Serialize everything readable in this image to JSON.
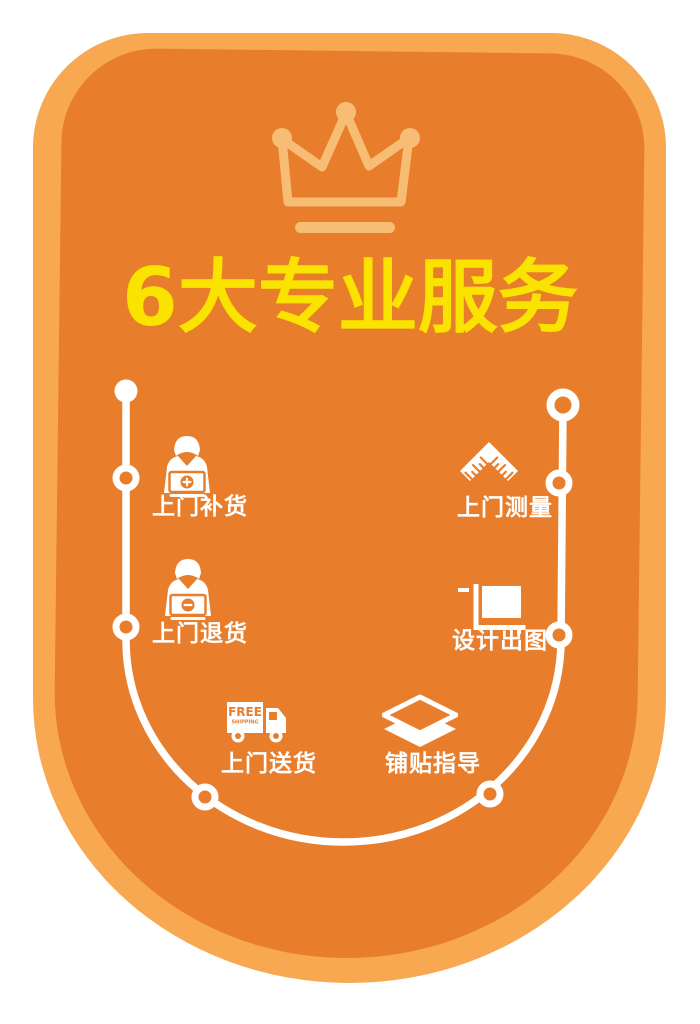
{
  "poster": {
    "title": "6大专业服务",
    "crown_icon": "crown-outline",
    "services": [
      {
        "id": "restock",
        "label": "上门补货",
        "icon": "person-box-plus"
      },
      {
        "id": "returns",
        "label": "上门退货",
        "icon": "person-box-minus"
      },
      {
        "id": "delivery",
        "label": "上门送货",
        "icon": "free-shipping-truck",
        "badge_line1": "FREE",
        "badge_line2": "SHIPPING"
      },
      {
        "id": "tiling",
        "label": "铺贴指导",
        "icon": "tile-layers"
      },
      {
        "id": "design",
        "label": "设计出图",
        "icon": "blueprint-square"
      },
      {
        "id": "measure",
        "label": "上门测量",
        "icon": "angle-ruler"
      }
    ],
    "colors": {
      "outer_border": "#F8A851",
      "panel": "#E87E2C",
      "title_yellow": "#FBE300",
      "crown": "#F8BD74",
      "line_white": "#FFFFFF"
    }
  }
}
